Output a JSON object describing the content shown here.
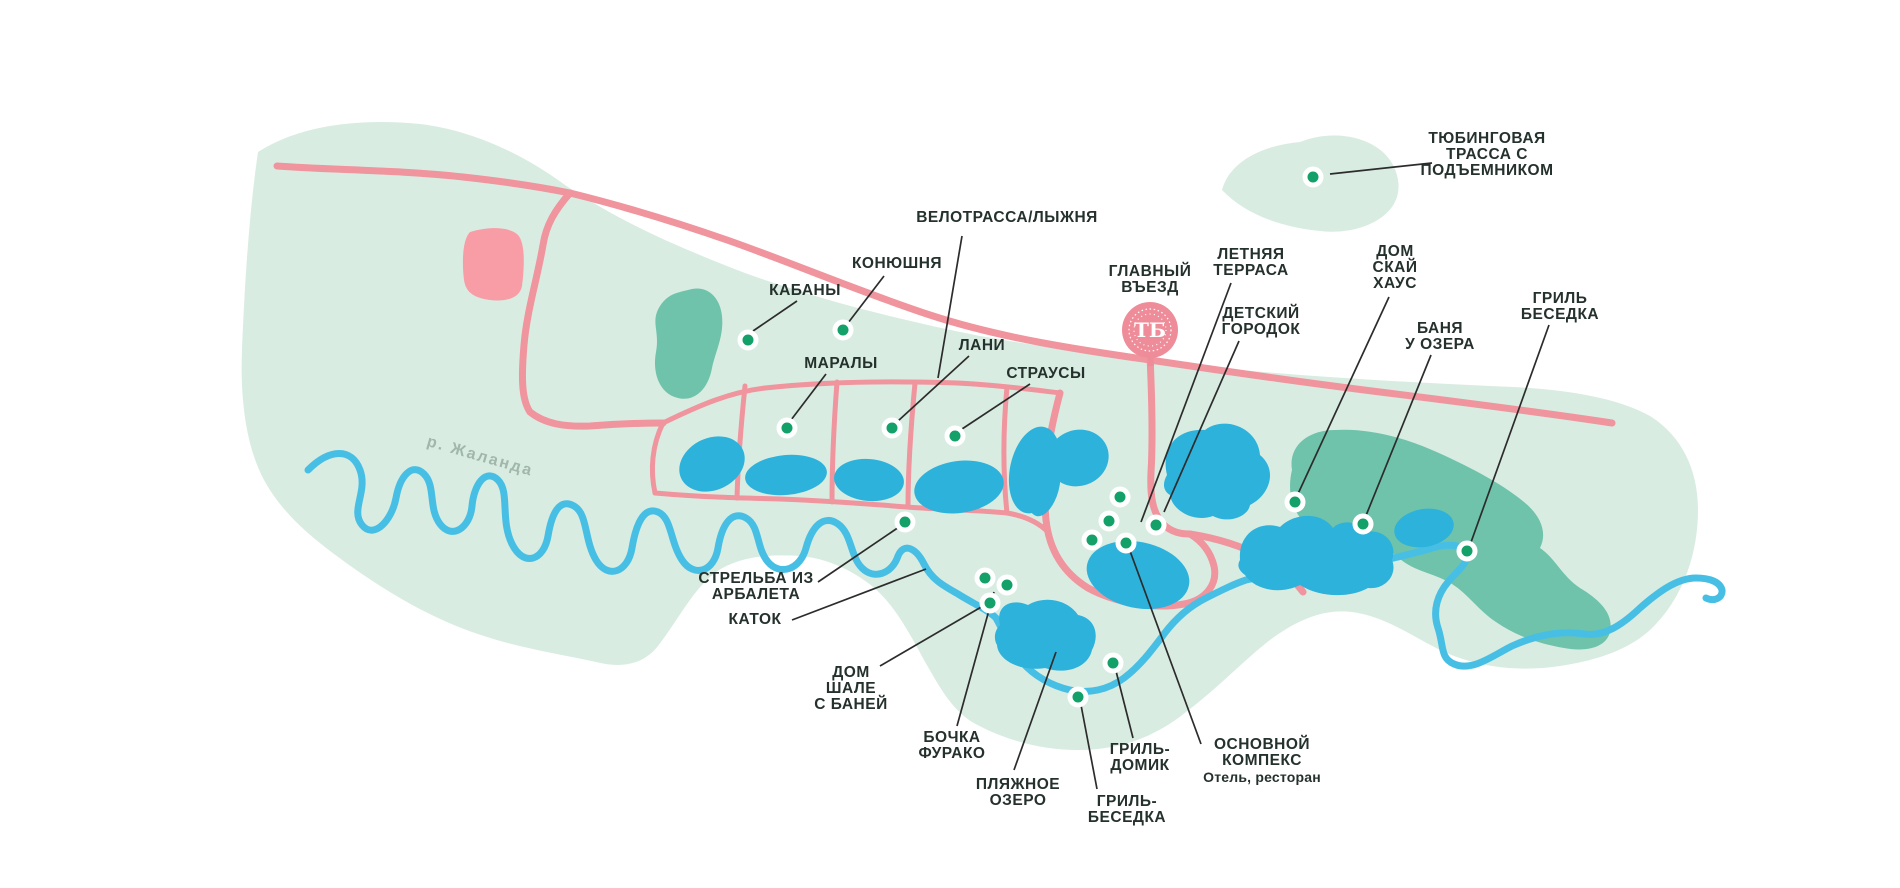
{
  "colors": {
    "territory": "#d9ece2",
    "forest": "#6fc3ab",
    "lake": "#2db2dc",
    "river": "#47bfe5",
    "road": "#f0949e",
    "marker_green": "#13a169",
    "entrance_pink": "#ee8d99",
    "label_text": "#25312c",
    "river_label_gray": "#a2b7ab"
  },
  "river_label": "р. Жаланда",
  "entrance": {
    "monogram": "ТБ"
  },
  "labels": {
    "tubing": [
      "ТЮБИНГОВАЯ",
      "ТРАССА С",
      "ПОДЪЕМНИКОМ"
    ],
    "velotrassa": [
      "ВЕЛОТРАССА/ЛЫЖНЯ"
    ],
    "konyushnya": [
      "КОНЮШНЯ"
    ],
    "kabany": [
      "КАБАНЫ"
    ],
    "maraly": [
      "МАРАЛЫ"
    ],
    "lani": [
      "ЛАНИ"
    ],
    "strausy": [
      "СТРАУСЫ"
    ],
    "glavny_vezd": [
      "ГЛАВНЫЙ",
      "ВЪЕЗД"
    ],
    "letnyaya_terrasa": [
      "ЛЕТНЯЯ",
      "ТЕРРАСА"
    ],
    "detsky_gorodok": [
      "ДЕТСКИЙ",
      "ГОРОДОК"
    ],
    "dom_sky_house": [
      "ДОМ",
      "СКАЙ",
      "ХАУС"
    ],
    "banya_u_ozera": [
      "БАНЯ",
      "У ОЗЕРА"
    ],
    "gril_besedka_east": [
      "ГРИЛЬ",
      "БЕСЕДКА"
    ],
    "strelba": [
      "СТРЕЛЬБА ИЗ",
      "АРБАЛЕТА"
    ],
    "katok": [
      "КАТОК"
    ],
    "dom_shale": [
      "ДОМ",
      "ШАЛЕ",
      "С БАНЕЙ"
    ],
    "bochka_furako": [
      "БОЧКА",
      "ФУРАКО"
    ],
    "plyazhnoe_ozero": [
      "ПЛЯЖНОЕ",
      "ОЗЕРО"
    ],
    "gril_domik": [
      "ГРИЛЬ-",
      "ДОМИК"
    ],
    "gril_besedka_south": [
      "ГРИЛЬ-",
      "БЕСЕДКА"
    ],
    "osnovnoy_kompeks": [
      "ОСНОВНОЙ",
      "КОМПЕКС"
    ],
    "osnovnoy_sub": "Отель, ресторан"
  },
  "markers": [
    "tubing-hill",
    "kabany",
    "konyushnya",
    "maraly",
    "lani",
    "strausy",
    "strelba-iz-arbaleta",
    "complex-1",
    "complex-2",
    "complex-3",
    "complex-4",
    "letnyaya-terrasa",
    "dom-sky-house",
    "banya-u-ozera",
    "gril-besedka-east",
    "bochka-furako-1",
    "bochka-furako-2",
    "dom-shale",
    "gril-domik",
    "gril-besedka-south"
  ]
}
